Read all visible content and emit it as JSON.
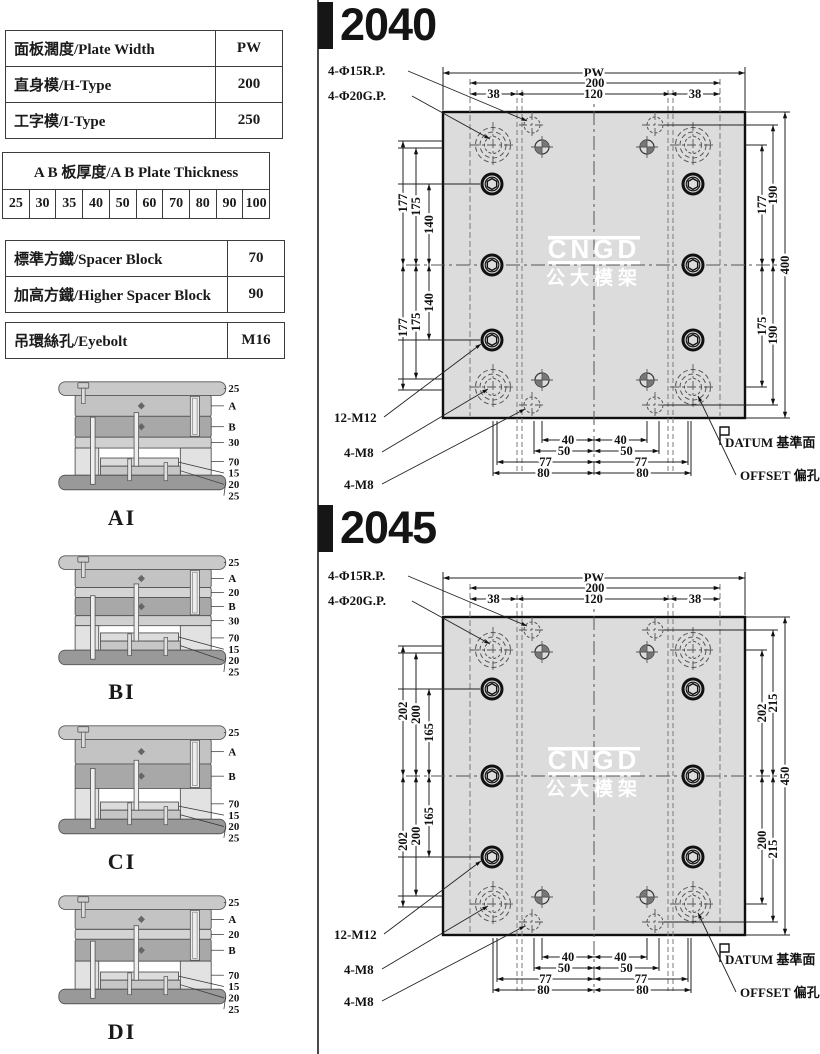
{
  "colors": {
    "accent_black": "#161616",
    "plate_gray": "#dcdcdc",
    "line_dark": "#111111"
  },
  "left_panel": {
    "table1": {
      "rows": [
        {
          "label": "面板濶度/Plate Width",
          "value": "PW"
        },
        {
          "label": "直身模/H-Type",
          "value": "200"
        },
        {
          "label": "工字模/I-Type",
          "value": "250"
        }
      ]
    },
    "thickness_table": {
      "header": "A B 板厚度/A B Plate Thickness",
      "values": [
        "25",
        "30",
        "35",
        "40",
        "50",
        "60",
        "70",
        "80",
        "90",
        "100"
      ]
    },
    "spacer_table": {
      "rows": [
        {
          "label": "標準方鐵/Spacer Block",
          "value": "70"
        },
        {
          "label": "加高方鐵/Higher Spacer Block",
          "value": "90"
        }
      ]
    },
    "eyebolt_table": {
      "rows": [
        {
          "label": "吊環絲孔/Eyebolt",
          "value": "M16"
        }
      ]
    },
    "mold_sections": [
      {
        "name": "AI",
        "labels": [
          "25",
          "A",
          "B",
          "30",
          "70",
          "15",
          "20",
          "25"
        ]
      },
      {
        "name": "BI",
        "labels": [
          "25",
          "A",
          "20",
          "B",
          "30",
          "70",
          "15",
          "20",
          "25"
        ]
      },
      {
        "name": "CI",
        "labels": [
          "25",
          "A",
          "B",
          "70",
          "15",
          "20",
          "25"
        ]
      },
      {
        "name": "DI",
        "labels": [
          "25",
          "A",
          "20",
          "B",
          "70",
          "15",
          "20",
          "25"
        ]
      }
    ]
  },
  "drawings": [
    {
      "title": "2040",
      "callouts": {
        "rp": "4-Φ15R.P.",
        "gp": "4-Φ20G.P.",
        "m12": "12-M12",
        "m8_1": "4-M8",
        "m8_2": "4-M8",
        "datum": "DATUM 基準面",
        "offset": "OFFSET 偏孔"
      },
      "top_dims": {
        "pw": "PW",
        "width": "200",
        "inner": "120",
        "left": "38",
        "right": "38"
      },
      "left_dims": {
        "top": [
          "177",
          "175",
          "140"
        ],
        "bottom": [
          "177",
          "175",
          "140"
        ]
      },
      "right_dims": {
        "top": [
          "177",
          "190"
        ],
        "bottom": [
          "175",
          "190"
        ],
        "overall": "400"
      },
      "bottom_dims": [
        [
          "40",
          "40"
        ],
        [
          "50",
          "50"
        ],
        [
          "77",
          "77"
        ],
        [
          "80",
          "80"
        ]
      ],
      "watermark": {
        "line1": "CNGD",
        "line2": "公大模架"
      }
    },
    {
      "title": "2045",
      "callouts": {
        "rp": "4-Φ15R.P.",
        "gp": "4-Φ20G.P.",
        "m12": "12-M12",
        "m8_1": "4-M8",
        "m8_2": "4-M8",
        "datum": "DATUM 基準面",
        "offset": "OFFSET 偏孔"
      },
      "top_dims": {
        "pw": "PW",
        "width": "200",
        "inner": "120",
        "left": "38",
        "right": "38"
      },
      "left_dims": {
        "top": [
          "202",
          "200",
          "165"
        ],
        "bottom": [
          "202",
          "200",
          "165"
        ]
      },
      "right_dims": {
        "top": [
          "202",
          "215"
        ],
        "bottom": [
          "200",
          "215"
        ],
        "overall": "450"
      },
      "bottom_dims": [
        [
          "40",
          "40"
        ],
        [
          "50",
          "50"
        ],
        [
          "77",
          "77"
        ],
        [
          "80",
          "80"
        ]
      ],
      "watermark": {
        "line1": "CNGD",
        "line2": "公大模架"
      }
    }
  ]
}
